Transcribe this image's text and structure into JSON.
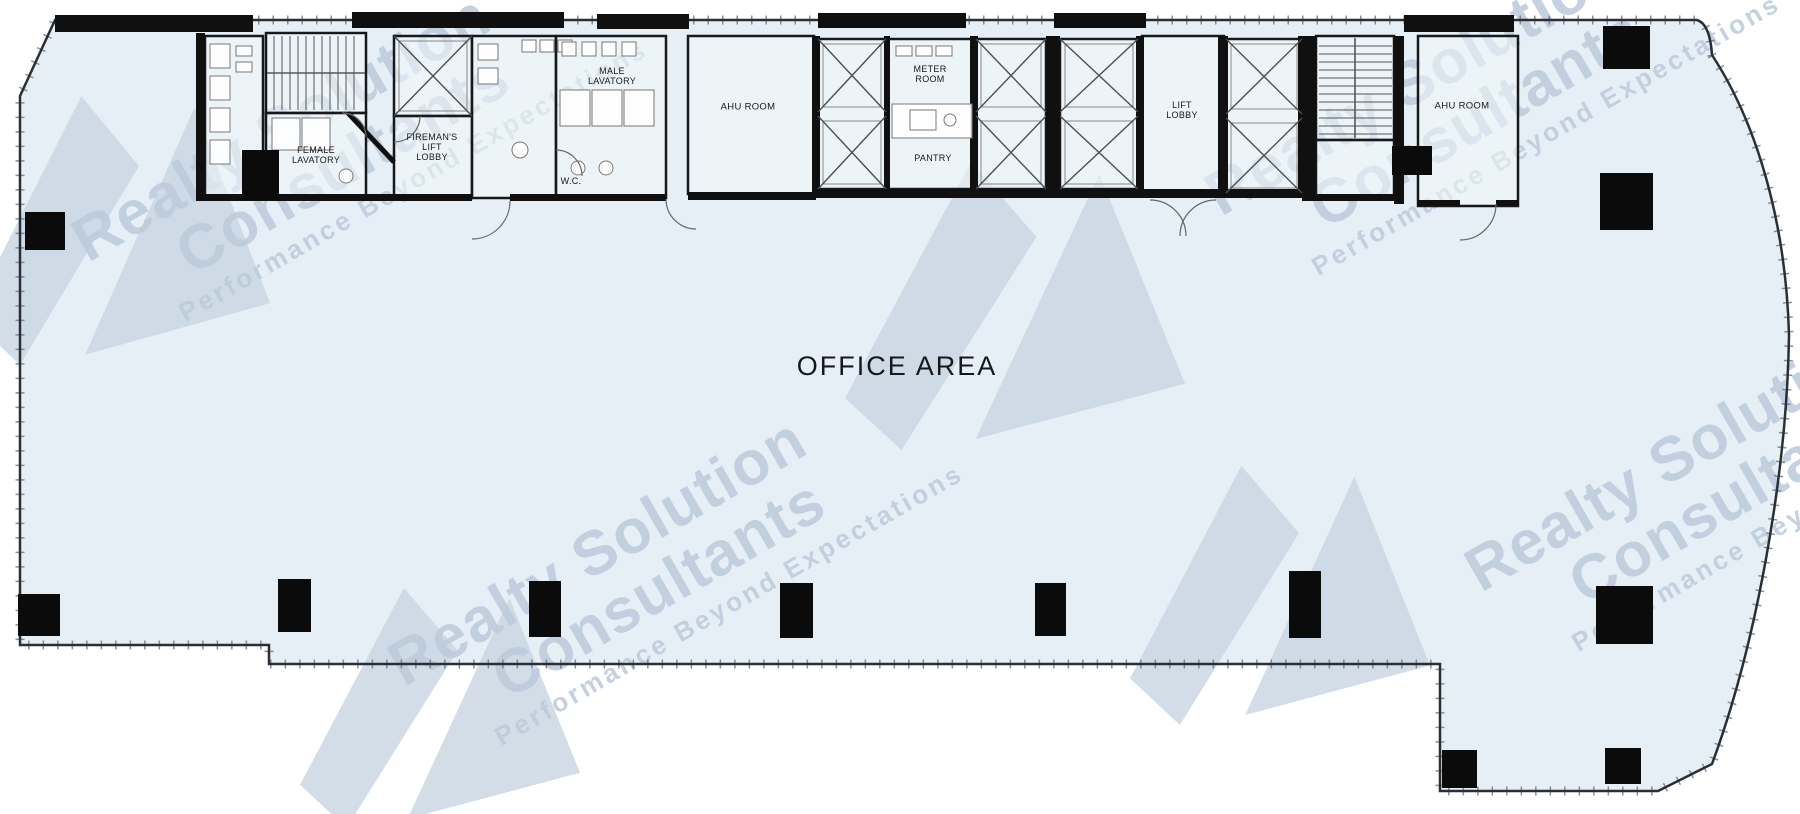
{
  "plan": {
    "colors": {
      "floor_fill": "#e6eff6",
      "room_fill": "#f1f6f9",
      "wall": "#141619",
      "detail_line": "#5a6068",
      "label_text": "#16181c"
    },
    "labels": [
      {
        "id": "office-area",
        "lines": [
          "OFFICE AREA"
        ],
        "x": 897,
        "y": 366,
        "size": 27,
        "spacing": 2
      },
      {
        "id": "female-lavatory",
        "lines": [
          "FEMALE",
          "LAVATORY"
        ],
        "x": 316,
        "y": 155,
        "size": 9
      },
      {
        "id": "firemans-lift-lobby",
        "lines": [
          "FIREMAN'S",
          "LIFT",
          "LOBBY"
        ],
        "x": 432,
        "y": 147,
        "size": 9
      },
      {
        "id": "male-lavatory",
        "lines": [
          "MALE",
          "LAVATORY"
        ],
        "x": 612,
        "y": 76,
        "size": 9
      },
      {
        "id": "wc",
        "lines": [
          "W.C."
        ],
        "x": 571,
        "y": 181,
        "size": 9
      },
      {
        "id": "ahu-room-left",
        "lines": [
          "AHU ROOM"
        ],
        "x": 748,
        "y": 108,
        "size": 9.5
      },
      {
        "id": "meter-room",
        "lines": [
          "METER",
          "ROOM"
        ],
        "x": 930,
        "y": 74,
        "size": 9
      },
      {
        "id": "pantry",
        "lines": [
          "PANTRY"
        ],
        "x": 933,
        "y": 158,
        "size": 9
      },
      {
        "id": "lift-lobby",
        "lines": [
          "LIFT",
          "LOBBY"
        ],
        "x": 1182,
        "y": 110,
        "size": 9
      },
      {
        "id": "ahu-room-right",
        "lines": [
          "AHU ROOM"
        ],
        "x": 1462,
        "y": 107,
        "size": 9.5
      }
    ]
  },
  "watermark": {
    "line1": "Realty Solution",
    "line2": "Consultants",
    "line3": "Performance Beyond Expectations",
    "text_color": "#bccadb",
    "logo_color": "#c9d5e3",
    "text_tiles": [
      {
        "x": 62,
        "y": 218,
        "scale": 1.0
      },
      {
        "x": 378,
        "y": 642,
        "scale": 1.0
      },
      {
        "x": 1455,
        "y": 548,
        "scale": 1.0
      },
      {
        "x": 1195,
        "y": 172,
        "scale": 1.0
      }
    ],
    "logo_tiles": [
      {
        "x": -30,
        "y": 85,
        "w": 300,
        "h": 280
      },
      {
        "x": 845,
        "y": 150,
        "w": 340,
        "h": 300
      },
      {
        "x": 1130,
        "y": 455,
        "w": 300,
        "h": 270
      },
      {
        "x": 300,
        "y": 578,
        "w": 280,
        "h": 250
      }
    ]
  }
}
